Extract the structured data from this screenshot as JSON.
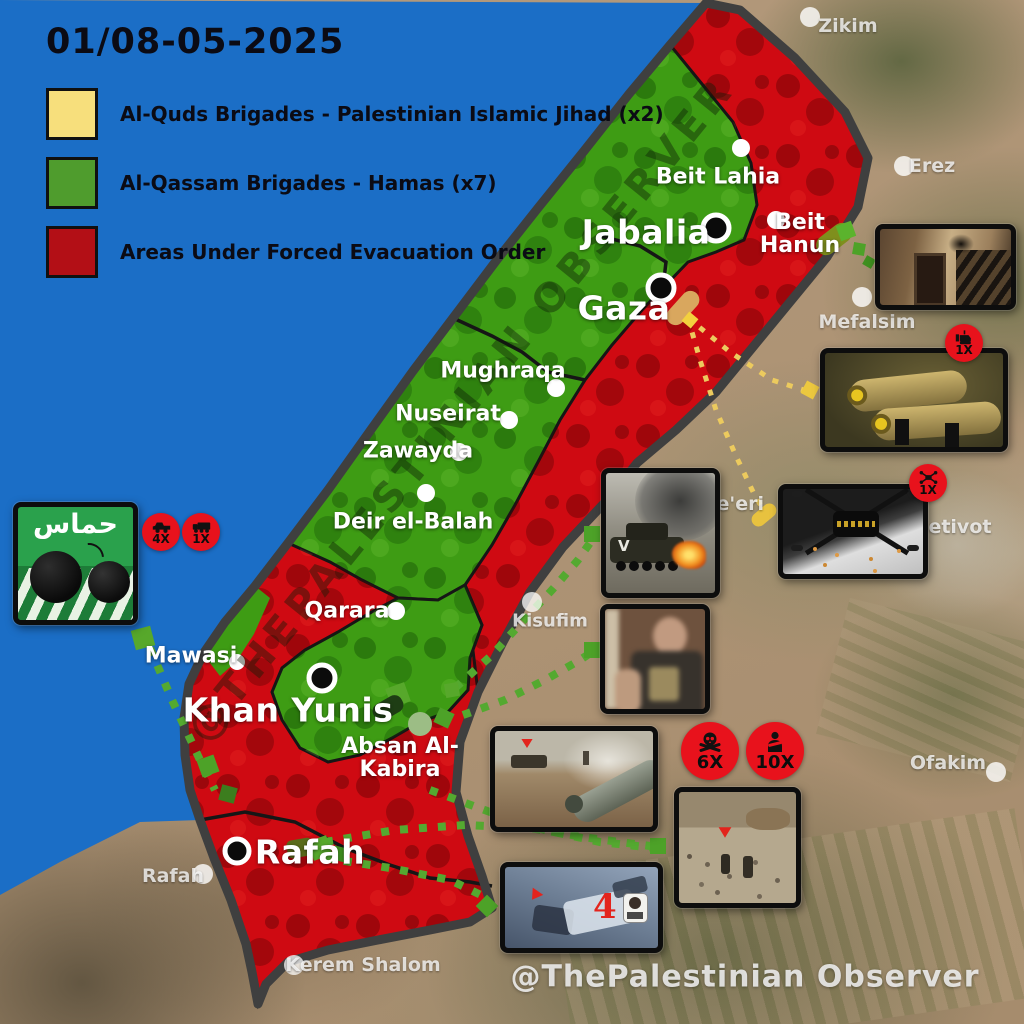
{
  "header": {
    "date": "01/08-05-2025"
  },
  "legend": {
    "items": [
      {
        "swatch_color": "#f7df7c",
        "label": "Al-Quds Brigades -  Palestinian Islamic Jihad  (x2)"
      },
      {
        "swatch_color": "#4f9c2d",
        "label": "Al-Qassam Brigades -  Hamas (x7)"
      },
      {
        "swatch_color": "#b30f16",
        "label": "Areas Under Forced Evacuation Order"
      }
    ]
  },
  "watermarks": {
    "diagonal": "@THEPALESTINIAN OBSERVER",
    "bottom": "@ThePalestinian Observer"
  },
  "map": {
    "gaza_cities": [
      {
        "name": "Beit Lahia"
      },
      {
        "name": "Jabalia"
      },
      {
        "name": "Beit Hanun"
      },
      {
        "name": "Gaza"
      },
      {
        "name": "Mughraqa"
      },
      {
        "name": "Nuseirat"
      },
      {
        "name": "Zawayda"
      },
      {
        "name": "Deir el-Balah"
      },
      {
        "name": "Qarara"
      },
      {
        "name": "Mawasi"
      },
      {
        "name": "Khan Yunis"
      },
      {
        "name": "Absan Al-Kabira"
      },
      {
        "name": "Rafah"
      }
    ],
    "israel_egypt_cities": [
      {
        "name": "Zikim"
      },
      {
        "name": "Erez"
      },
      {
        "name": "Mefalsim"
      },
      {
        "name": "Be'eri"
      },
      {
        "name": "Netivot"
      },
      {
        "name": "Kisufim"
      },
      {
        "name": "Ofakim"
      },
      {
        "name": "Rafah"
      },
      {
        "name": "Kerem Shalom"
      }
    ]
  },
  "badges": [
    {
      "icon": "jeep-icon",
      "count": "4X"
    },
    {
      "icon": "truck-icon",
      "count": "1X"
    },
    {
      "icon": "bulldozer-icon",
      "count": "1X"
    },
    {
      "icon": "drone-icon",
      "count": "1X"
    },
    {
      "icon": "skull-icon",
      "count": "6X"
    },
    {
      "icon": "injured-person-icon",
      "count": "10X"
    }
  ],
  "photos": [
    {
      "name": "stairwell-interior"
    },
    {
      "name": "aerial-bombs"
    },
    {
      "name": "quadcopter-drone"
    },
    {
      "name": "burning-tank",
      "marking": "V"
    },
    {
      "name": "soldier-portrait"
    },
    {
      "name": "rpg-aimed-at-tank"
    },
    {
      "name": "soldiers-in-rubble"
    },
    {
      "name": "night-vision-vehicle",
      "overlay_number": "4"
    },
    {
      "name": "ied-mines-on-flag",
      "flag_text": "حماس"
    }
  ],
  "colors": {
    "sea": "#1b6ec6",
    "strip_green": "#3e9c14",
    "strip_red": "#cf0a12",
    "strip_border": "#3f3f3f",
    "legend_yellow": "#f7df7c",
    "legend_green": "#4f9c2d",
    "legend_red": "#b30f16",
    "marker_green": "#55aa30",
    "alquds_yellow": "#e0b35c",
    "badge_red": "#e8121c"
  }
}
